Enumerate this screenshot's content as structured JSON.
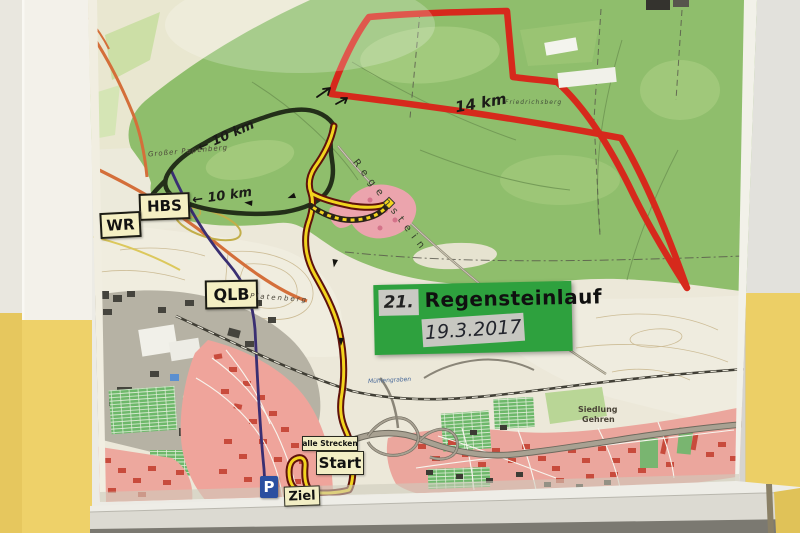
{
  "event_sign": {
    "number": "21.",
    "title": "Regensteinlauf",
    "date": "19.3.2017"
  },
  "route_labels": {
    "red_distance": "14 km",
    "upper_black_distance": "10 km",
    "lower_black_distance": "10 km",
    "upper_arrow": "←",
    "lower_arrow": "←"
  },
  "road_signs": {
    "hbs": "HBS",
    "wr": "WR",
    "qlb": "QLB"
  },
  "course_markers": {
    "all_courses": "alle Strecken",
    "start": "Start",
    "finish": "Ziel",
    "parking": "P"
  },
  "map_place_labels": {
    "grosser_papenberg": "Großer Papenberg",
    "regenstein": "Regenstein",
    "platenberg": "Platenberg",
    "friedrichsberg": "Friedrichsberg",
    "siedlung_line1": "Siedlung",
    "siedlung_line2": "Gehren",
    "muehlengraben": "Mühlengraben"
  },
  "colors": {
    "route_red": "#d6291c",
    "route_black": "#232f19",
    "route_yellow": "#f2d41e",
    "event_sign_green": "#2ea13e",
    "forest_green": "#8fbe6c",
    "wall_yellow": "#edd06a",
    "parking_blue": "#2b4fa0",
    "sign_background": "#f4efc3"
  }
}
